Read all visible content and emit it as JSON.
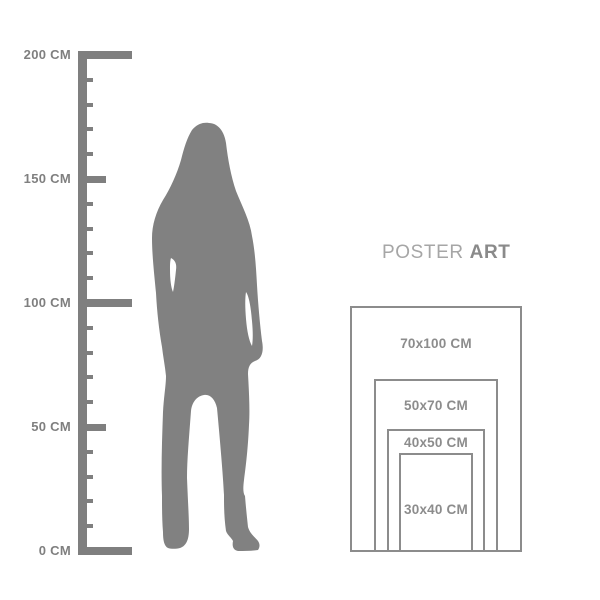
{
  "background": "#ffffff",
  "colors": {
    "ruler": "#7f7f7f",
    "ruler_label": "#7f7f7f",
    "silhouette": "#818181",
    "poster_border": "#8c8c8c",
    "poster_label": "#8c8c8c",
    "heading_poster": "#a6a6a6",
    "heading_art": "#8a8a8a"
  },
  "heading": {
    "word1": "POSTER",
    "word2": "ART"
  },
  "ruler": {
    "unit": "CM",
    "min_cm": 0,
    "max_cm": 200,
    "tick_step_cm": 10,
    "medium_every_cm": 50,
    "major_every_cm": 100,
    "labeled_ticks": [
      {
        "cm": 200,
        "label": "200 CM"
      },
      {
        "cm": 150,
        "label": "150 CM"
      },
      {
        "cm": 100,
        "label": "100 CM"
      },
      {
        "cm": 50,
        "label": "50 CM"
      },
      {
        "cm": 0,
        "label": "0 CM"
      }
    ]
  },
  "poster": {
    "sizes": [
      {
        "label": "70x100 CM",
        "width_cm": 70,
        "height_cm": 100
      },
      {
        "label": "50x70 CM",
        "width_cm": 50,
        "height_cm": 70
      },
      {
        "label": "40x50 CM",
        "width_cm": 40,
        "height_cm": 50
      },
      {
        "label": "30x40 CM",
        "width_cm": 30,
        "height_cm": 40
      }
    ]
  }
}
